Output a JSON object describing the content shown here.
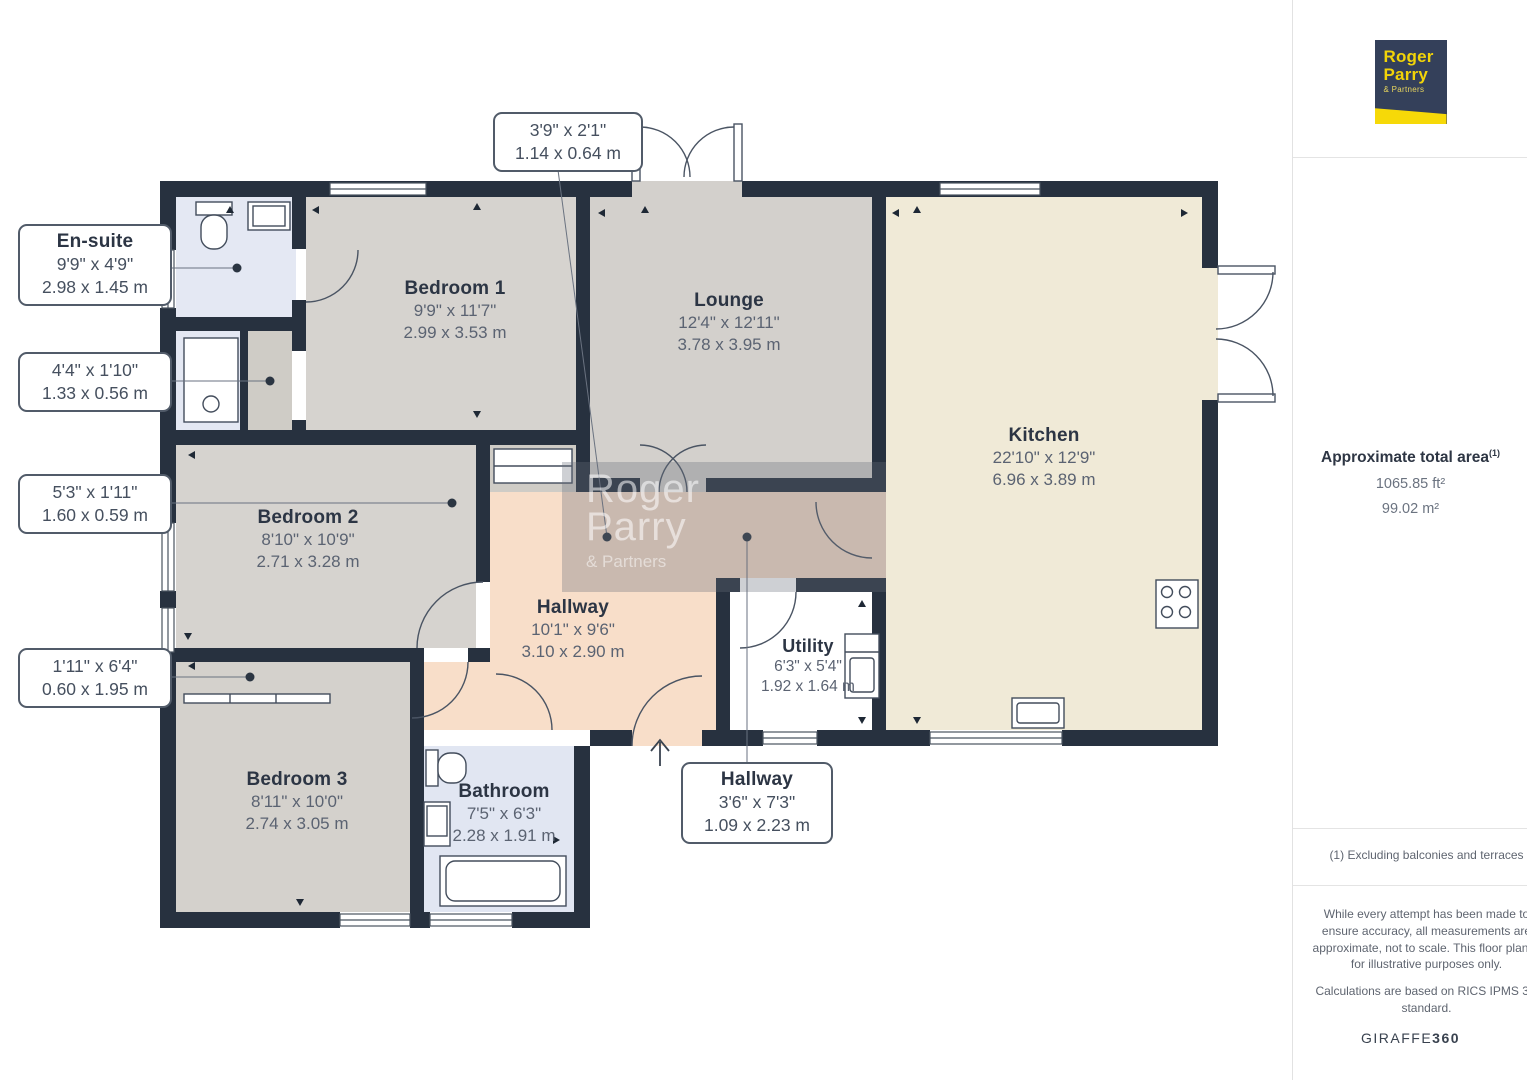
{
  "rooms": [
    {
      "name": "Bedroom 1",
      "imperial": "9'9\" x 11'7\"",
      "metric": "2.99 x 3.53 m"
    },
    {
      "name": "Lounge",
      "imperial": "12'4\" x 12'11\"",
      "metric": "3.78 x 3.95 m"
    },
    {
      "name": "Kitchen",
      "imperial": "22'10\" x 12'9\"",
      "metric": "6.96 x 3.89 m"
    },
    {
      "name": "Bedroom 2",
      "imperial": "8'10\" x 10'9\"",
      "metric": "2.71 x 3.28 m"
    },
    {
      "name": "Hallway",
      "imperial": "10'1\" x 9'6\"",
      "metric": "3.10 x 2.90 m"
    },
    {
      "name": "Utility",
      "imperial": "6'3\" x 5'4\"",
      "metric": "1.92 x 1.64 m"
    },
    {
      "name": "Bedroom 3",
      "imperial": "8'11\" x 10'0\"",
      "metric": "2.74 x 3.05 m"
    },
    {
      "name": "Bathroom",
      "imperial": "7'5\" x 6'3\"",
      "metric": "2.28 x 1.91 m"
    }
  ],
  "callouts": [
    {
      "title": "",
      "imperial": "3'9\" x 2'1\"",
      "metric": "1.14 x 0.64 m"
    },
    {
      "title": "En-suite",
      "imperial": "9'9\" x 4'9\"",
      "metric": "2.98 x 1.45 m"
    },
    {
      "title": "",
      "imperial": "4'4\" x 1'10\"",
      "metric": "1.33 x 0.56 m"
    },
    {
      "title": "",
      "imperial": "5'3\" x 1'11\"",
      "metric": "1.60 x 0.59 m"
    },
    {
      "title": "",
      "imperial": "1'11\" x 6'4\"",
      "metric": "0.60 x 1.95 m"
    },
    {
      "title": "Hallway",
      "imperial": "3'6\" x 7'3\"",
      "metric": "1.09 x 2.23 m"
    }
  ],
  "watermark": {
    "line1": "Roger",
    "line2": "Parry",
    "line3": "& Partners"
  },
  "sidebar": {
    "logo": {
      "line1": "Roger",
      "line2": "Parry",
      "line3": "& Partners"
    },
    "area_title": "Approximate total area",
    "area_footnote_mark": "(1)",
    "area_ft": "1065.85 ft²",
    "area_m": "99.02 m²",
    "footnote": "(1) Excluding balconies and terraces",
    "disclaimer1": "While every attempt has been made to ensure accuracy, all measurements are approximate, not to scale. This floor plan is for illustrative purposes only.",
    "disclaimer2": "Calculations are based on RICS IPMS 3C standard.",
    "brand": "GIRAFFE",
    "brand_suffix": "360"
  },
  "colors": {
    "wall": "#27313f",
    "bedroom_floor": "#d6d3cf",
    "kitchen_floor": "#f0ead7",
    "hallway_floor": "#f8dec9",
    "bathroom_floor": "#e1e6f2",
    "logo_navy": "#34405a",
    "logo_yellow": "#f6d908"
  }
}
